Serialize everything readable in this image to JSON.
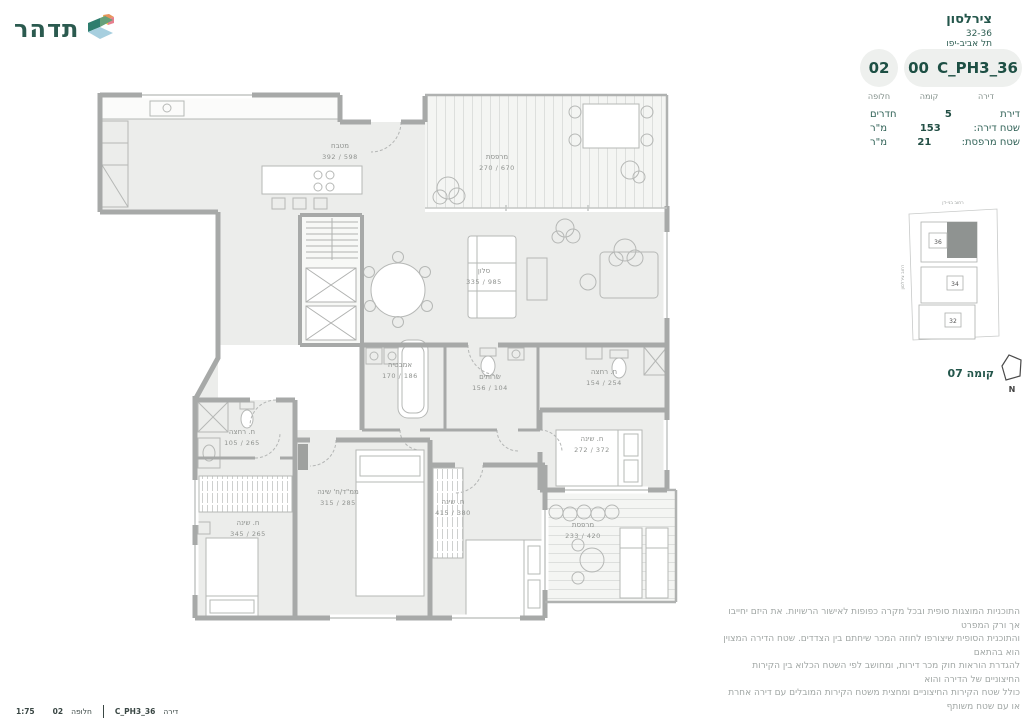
{
  "header": {
    "logo_text": "תדהר",
    "project_name": "צירלסון",
    "project_numbers": "32-36",
    "project_city": "תל אביב-יפו"
  },
  "unit_info": {
    "alternative_value": "02",
    "alternative_label": "חלופה",
    "floor_value": "00",
    "floor_label": "קומה",
    "unit_value": "36_C_PH3",
    "unit_label": "דירה"
  },
  "details": {
    "rows": [
      {
        "label": "דירת",
        "value": "5",
        "unit": "חדרים"
      },
      {
        "label": "שטח דירה:",
        "value": "153",
        "unit": "מ\"ר"
      },
      {
        "label": "שטח מרפסת:",
        "value": "21",
        "unit": "מ\"ר"
      }
    ]
  },
  "key_plan": {
    "street_top": "רחוב בני-דן",
    "street_left": "רחוב צירלסון",
    "buildings": [
      "36",
      "34",
      "32"
    ]
  },
  "floor_indicator": "קומה 07",
  "north_label": "N",
  "plan": {
    "rooms": [
      {
        "name": "מטבח",
        "dims": "598 / 392"
      },
      {
        "name": "מרפסת",
        "dims": "670 / 270"
      },
      {
        "name": "סלון",
        "dims": "985 / 335"
      },
      {
        "name": "אמבטיה",
        "dims": "186 / 170"
      },
      {
        "name": "שרותים",
        "dims": "104 / 156"
      },
      {
        "name": "ח. רחצה",
        "dims": "254 / 154"
      },
      {
        "name": "ח. שינה",
        "dims": "372 / 272"
      },
      {
        "name": "ח. רחצה",
        "dims": "265 / 105"
      },
      {
        "name": "ממ\"ד/ח' שינה",
        "dims": "285 / 315"
      },
      {
        "name": "ח. שינה",
        "dims": "265 / 345"
      },
      {
        "name": "ח. שינה",
        "dims": "380 / 415"
      },
      {
        "name": "מרפסת",
        "dims": "420 / 233"
      }
    ]
  },
  "disclaimer": {
    "lines": [
      "התוכניות המוצגות סופית ובכל מקרה כפופות לאישור הרשויות. את היזם יחייבו אך ורק המפרט",
      "והתוכנית הסופית שיצורפו לחוזה המכר שיחתם בין הצדדים. שטח הדירה המצוין הוא בהתאם",
      "להגדרת הוראות חוק מכר דירות, ומחושב לפי השטח הכלוא בין הקירות החיצוניים של הדירה והוא",
      "כולל שטח הקירות החיצוניים ומחצית משטח הקירות המובלים עם דירה אחרת או עם שטח משותף"
    ]
  },
  "footer": {
    "scale": "1:75",
    "alt_label": "חלופה",
    "alt_value": "02",
    "unit_value": "36_C_PH3",
    "unit_label": "דירה"
  }
}
